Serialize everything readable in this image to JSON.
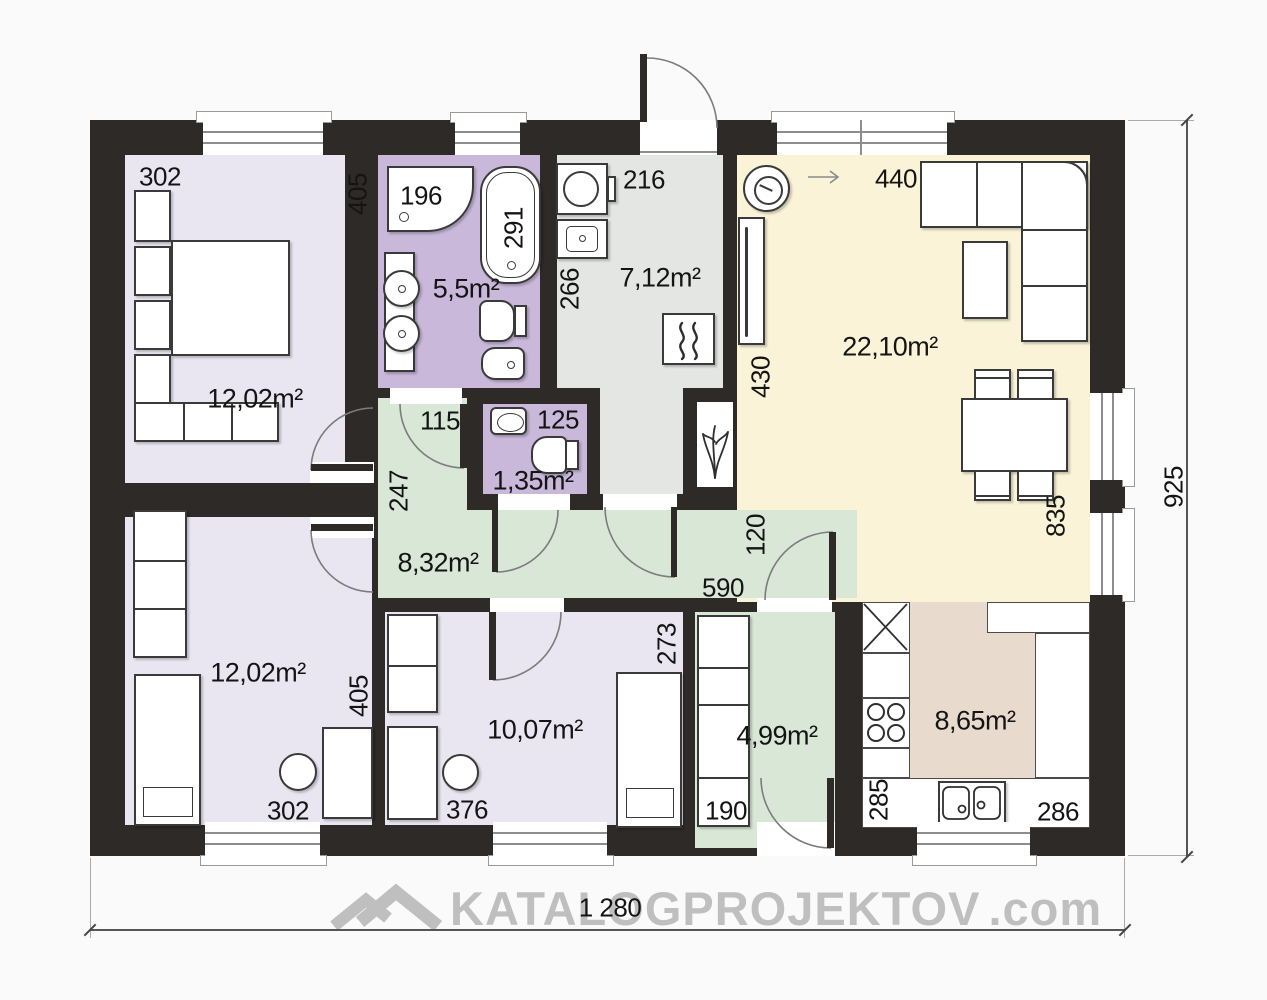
{
  "watermark": {
    "brand": "KATALOGPROJEKTOV",
    "tld": ".com"
  },
  "dimensions": {
    "total_width": "1 280",
    "total_height": "925"
  },
  "rooms": {
    "bedroom_top_left": {
      "area": "12,02m²",
      "width": "302",
      "depth": "405"
    },
    "bathroom": {
      "area": "5,5m²",
      "shower_width": "196",
      "bathtub_length": "291"
    },
    "hall": {
      "area": "7,12m²",
      "width": "216",
      "depth": "266"
    },
    "wc": {
      "area": "1,35m²",
      "width": "125"
    },
    "corridor": {
      "area": "8,32m²",
      "nook_width": "115",
      "nook_depth": "247",
      "length": "590",
      "passage_depth": "120"
    },
    "living_room": {
      "area": "22,10m²",
      "width": "440",
      "depth": "430",
      "dining_wall": "835"
    },
    "bedroom_bottom_left": {
      "area": "12,02m²",
      "width": "302",
      "depth": "405"
    },
    "bedroom_bottom_middle": {
      "area": "10,07m²",
      "width": "376",
      "depth": "273"
    },
    "mudroom": {
      "area": "4,99m²",
      "closet_width": "190"
    },
    "kitchen": {
      "area": "8,65m²",
      "depth": "285",
      "width": "286"
    }
  },
  "colors": {
    "wall": "#2e2a27",
    "bedroom": "#e9e6f1",
    "bath": "#c9b8da",
    "hall": "#e4e6e4",
    "living": "#faf3d8",
    "kitchen_floor": "#e8dacd",
    "green": "#d9e7d7",
    "paper": "#fafafa",
    "watermark": "#b5b5b5"
  }
}
